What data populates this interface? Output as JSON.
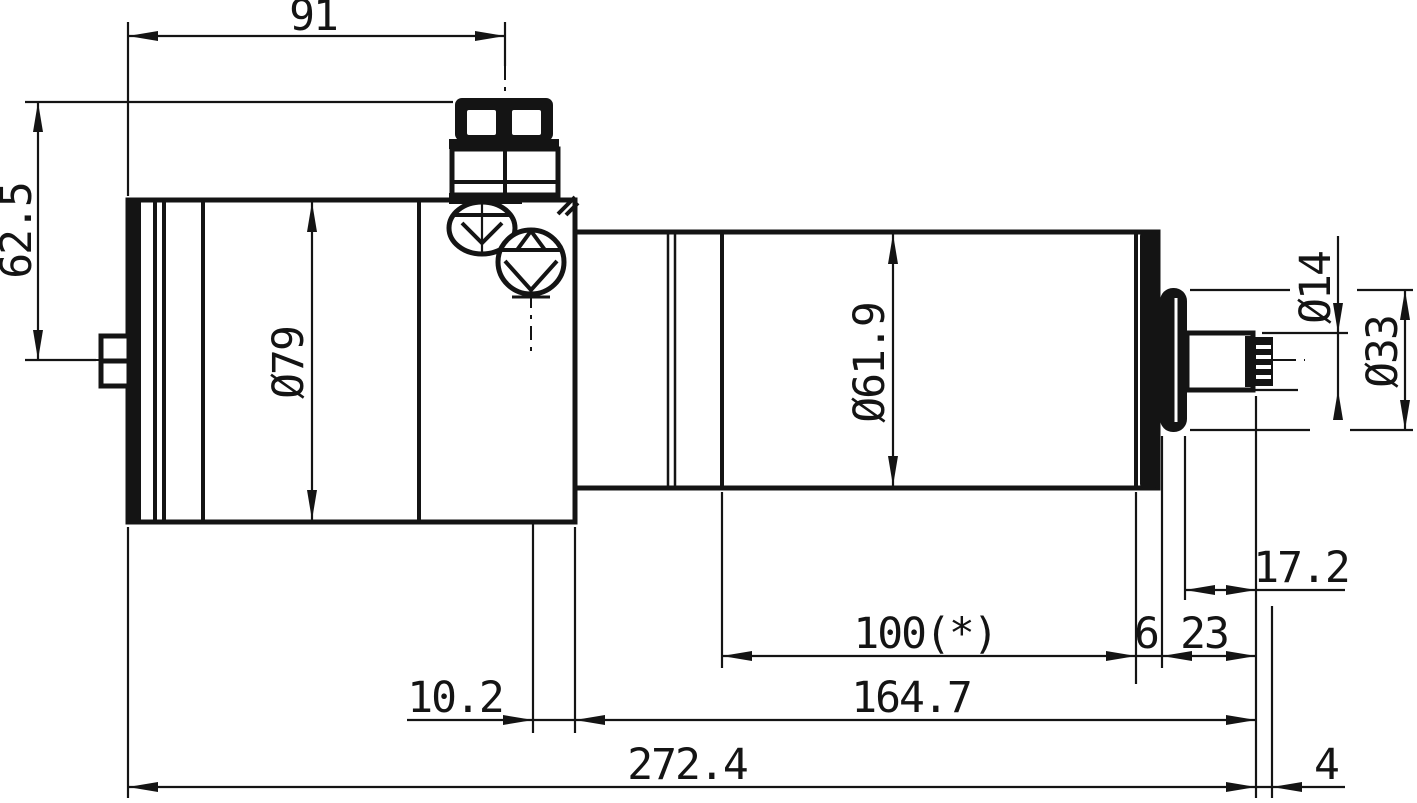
{
  "drawing": {
    "title": "Spindle motor dimension drawing",
    "units": "mm",
    "style": {
      "ink": "#141414",
      "background": "#ffffff"
    },
    "dimensions": {
      "connector_center_from_rear": "91",
      "connector_top_from_axis": "62.5",
      "motor_body_diameter": "Ø79",
      "spindle_body_diameter": "Ø61.9",
      "shaft_diameter": "Ø14",
      "collar_diameter": "Ø33",
      "nose_section_length": "100(*)",
      "end_cap_width": "6",
      "shaft_protrusion": "23",
      "shaft_exposed_length": "17.2",
      "screw_center_from_body_end": "10.2",
      "spindle_section_length": "164.7",
      "overall_length": "272.4",
      "thread_length": "4"
    }
  }
}
